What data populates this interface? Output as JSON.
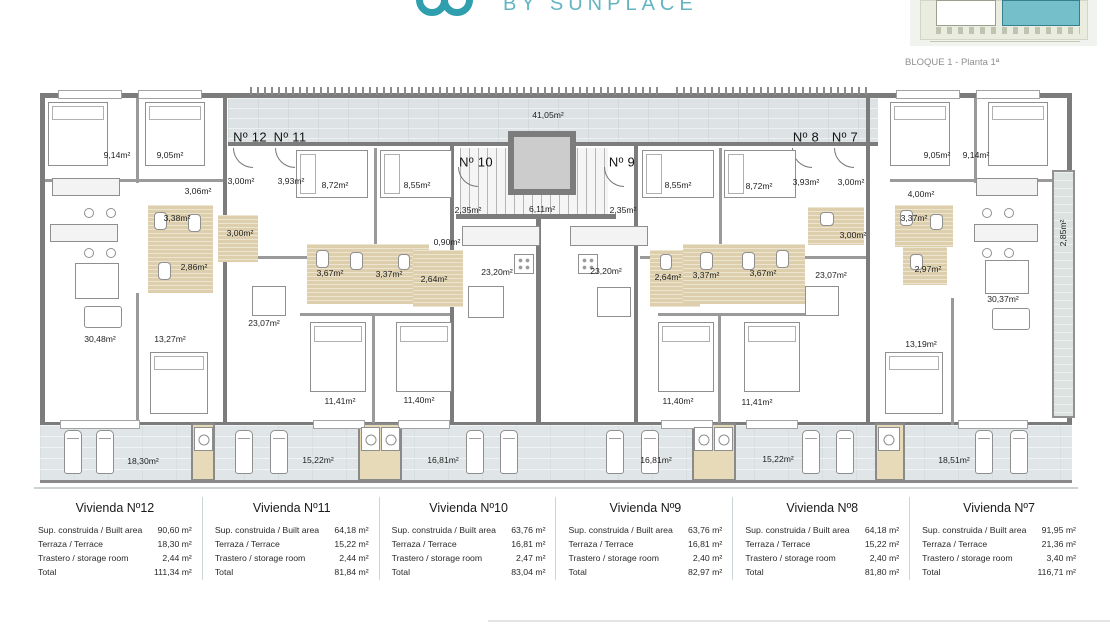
{
  "header": {
    "brand": "BY SUNPLACE"
  },
  "key_plan": {
    "caption": "BLOQUE 1 - Planta 1ª",
    "highlight_color": "#74bfc9"
  },
  "colors": {
    "teal_logo": "#2f9fae",
    "teal_text": "#63b5c1",
    "wall": "#7c7c7c",
    "terrace": "#e0e6e7",
    "bathroom": "#ddcfab"
  },
  "floorplan": {
    "labels": [
      {
        "t": "41,05m²",
        "x": 548,
        "y": 115
      },
      {
        "t": "Nº 12",
        "x": 250,
        "y": 137,
        "u": 1
      },
      {
        "t": "Nº 11",
        "x": 290,
        "y": 137,
        "u": 1
      },
      {
        "t": "Nº 10",
        "x": 476,
        "y": 162,
        "u": 1
      },
      {
        "t": "Nº 9",
        "x": 622,
        "y": 162,
        "u": 1
      },
      {
        "t": "Nº 8",
        "x": 806,
        "y": 137,
        "u": 1
      },
      {
        "t": "Nº 7",
        "x": 845,
        "y": 137,
        "u": 1
      },
      {
        "t": "9,14m²",
        "x": 117,
        "y": 155
      },
      {
        "t": "9,05m²",
        "x": 170,
        "y": 155
      },
      {
        "t": "3,06m²",
        "x": 198,
        "y": 191
      },
      {
        "t": "3,38m²",
        "x": 177,
        "y": 218
      },
      {
        "t": "3,00m²",
        "x": 241,
        "y": 181
      },
      {
        "t": "3,93m²",
        "x": 291,
        "y": 181
      },
      {
        "t": "3,00m²",
        "x": 240,
        "y": 233
      },
      {
        "t": "2,86m²",
        "x": 194,
        "y": 267
      },
      {
        "t": "8,72m²",
        "x": 335,
        "y": 185
      },
      {
        "t": "8,55m²",
        "x": 417,
        "y": 185
      },
      {
        "t": "3,67m²",
        "x": 330,
        "y": 273
      },
      {
        "t": "3,37m²",
        "x": 389,
        "y": 274
      },
      {
        "t": "2,64m²",
        "x": 434,
        "y": 279
      },
      {
        "t": "23,07m²",
        "x": 264,
        "y": 323
      },
      {
        "t": "30,48m²",
        "x": 100,
        "y": 339
      },
      {
        "t": "13,27m²",
        "x": 170,
        "y": 339
      },
      {
        "t": "11,41m²",
        "x": 340,
        "y": 401
      },
      {
        "t": "11,40m²",
        "x": 419,
        "y": 400
      },
      {
        "t": "18,30m²",
        "x": 143,
        "y": 461
      },
      {
        "t": "15,22m²",
        "x": 318,
        "y": 460
      },
      {
        "t": "16,81m²",
        "x": 443,
        "y": 460
      },
      {
        "t": "2,35m²",
        "x": 468,
        "y": 210
      },
      {
        "t": "6,11m²",
        "x": 542,
        "y": 209
      },
      {
        "t": "2,35m²",
        "x": 623,
        "y": 210
      },
      {
        "t": "0,90m²",
        "x": 447,
        "y": 242
      },
      {
        "t": "23,20m²",
        "x": 497,
        "y": 272
      },
      {
        "t": "23,20m²",
        "x": 606,
        "y": 271
      },
      {
        "t": "16,81m²",
        "x": 656,
        "y": 460
      },
      {
        "t": "8,55m²",
        "x": 678,
        "y": 185
      },
      {
        "t": "8,72m²",
        "x": 759,
        "y": 186
      },
      {
        "t": "3,93m²",
        "x": 806,
        "y": 182
      },
      {
        "t": "3,00m²",
        "x": 851,
        "y": 182
      },
      {
        "t": "3,00m²",
        "x": 853,
        "y": 235
      },
      {
        "t": "2,64m²",
        "x": 668,
        "y": 277
      },
      {
        "t": "3,37m²",
        "x": 706,
        "y": 275
      },
      {
        "t": "3,67m²",
        "x": 763,
        "y": 273
      },
      {
        "t": "23,07m²",
        "x": 831,
        "y": 275
      },
      {
        "t": "11,40m²",
        "x": 678,
        "y": 401
      },
      {
        "t": "11,41m²",
        "x": 757,
        "y": 402
      },
      {
        "t": "15,22m²",
        "x": 778,
        "y": 459
      },
      {
        "t": "9,05m²",
        "x": 937,
        "y": 155
      },
      {
        "t": "9,14m²",
        "x": 976,
        "y": 155
      },
      {
        "t": "4,00m²",
        "x": 921,
        "y": 194
      },
      {
        "t": "3,37m²",
        "x": 914,
        "y": 218
      },
      {
        "t": "2,97m²",
        "x": 928,
        "y": 269
      },
      {
        "t": "30,37m²",
        "x": 1003,
        "y": 299
      },
      {
        "t": "13,19m²",
        "x": 921,
        "y": 344
      },
      {
        "t": "18,51m²",
        "x": 954,
        "y": 460
      },
      {
        "t": "2,85m²",
        "x": 1063,
        "y": 233,
        "r": 1
      }
    ],
    "furniture": [
      [
        "bed",
        48,
        102,
        60,
        64
      ],
      [
        "bed",
        145,
        102,
        60,
        64
      ],
      [
        "bed",
        890,
        102,
        60,
        64
      ],
      [
        "bed",
        988,
        102,
        60,
        64
      ],
      [
        "bedh",
        296,
        150,
        72,
        48
      ],
      [
        "bedh",
        380,
        150,
        72,
        48
      ],
      [
        "bedh",
        642,
        150,
        72,
        48
      ],
      [
        "bedh",
        724,
        150,
        72,
        48
      ],
      [
        "bed",
        310,
        322,
        56,
        70
      ],
      [
        "bed",
        396,
        322,
        56,
        70
      ],
      [
        "bed",
        658,
        322,
        56,
        70
      ],
      [
        "bed",
        744,
        322,
        56,
        70
      ],
      [
        "bed",
        150,
        352,
        58,
        62
      ],
      [
        "bed",
        885,
        352,
        58,
        62
      ],
      [
        "table",
        75,
        263,
        44,
        36
      ],
      [
        "table",
        252,
        286,
        34,
        30
      ],
      [
        "table",
        468,
        286,
        36,
        32
      ],
      [
        "table",
        597,
        287,
        34,
        30
      ],
      [
        "table",
        805,
        286,
        34,
        30
      ],
      [
        "table",
        985,
        260,
        44,
        34
      ],
      [
        "sofa",
        84,
        306,
        38,
        22
      ],
      [
        "sofa",
        992,
        308,
        38,
        22
      ],
      [
        "counter",
        52,
        178,
        68,
        18
      ],
      [
        "counter",
        976,
        178,
        62,
        18
      ],
      [
        "counter",
        50,
        224,
        68,
        18
      ],
      [
        "counter",
        974,
        224,
        64,
        18
      ],
      [
        "counter",
        462,
        226,
        78,
        20
      ],
      [
        "counter",
        570,
        226,
        78,
        20
      ],
      [
        "stool",
        84,
        208,
        10,
        10
      ],
      [
        "stool",
        106,
        208,
        10,
        10
      ],
      [
        "stool",
        84,
        248,
        10,
        10
      ],
      [
        "stool",
        106,
        248,
        10,
        10
      ],
      [
        "stool",
        982,
        208,
        10,
        10
      ],
      [
        "stool",
        1004,
        208,
        10,
        10
      ],
      [
        "stool",
        982,
        248,
        10,
        10
      ],
      [
        "stool",
        1004,
        248,
        10,
        10
      ],
      [
        "hob",
        514,
        254,
        20,
        20
      ],
      [
        "hob",
        578,
        254,
        20,
        20
      ],
      [
        "washer",
        194,
        427,
        19,
        24
      ],
      [
        "washer",
        361,
        427,
        19,
        24
      ],
      [
        "washer",
        381,
        427,
        19,
        24
      ],
      [
        "washer",
        694,
        427,
        19,
        24
      ],
      [
        "washer",
        714,
        427,
        19,
        24
      ],
      [
        "washer",
        878,
        427,
        22,
        24
      ],
      [
        "lounger",
        64,
        430,
        18,
        44
      ],
      [
        "lounger",
        96,
        430,
        18,
        44
      ],
      [
        "lounger",
        235,
        430,
        18,
        44
      ],
      [
        "lounger",
        270,
        430,
        18,
        44
      ],
      [
        "lounger",
        466,
        430,
        18,
        44
      ],
      [
        "lounger",
        500,
        430,
        18,
        44
      ],
      [
        "lounger",
        606,
        430,
        18,
        44
      ],
      [
        "lounger",
        641,
        430,
        18,
        44
      ],
      [
        "lounger",
        802,
        430,
        18,
        44
      ],
      [
        "lounger",
        836,
        430,
        18,
        44
      ],
      [
        "lounger",
        975,
        430,
        18,
        44
      ],
      [
        "lounger",
        1010,
        430,
        18,
        44
      ],
      [
        "fix",
        154,
        212,
        13,
        18
      ],
      [
        "fix",
        188,
        214,
        13,
        18
      ],
      [
        "fix",
        158,
        262,
        13,
        18
      ],
      [
        "fix",
        316,
        250,
        13,
        18
      ],
      [
        "fix",
        350,
        252,
        13,
        18
      ],
      [
        "fix",
        398,
        254,
        12,
        16
      ],
      [
        "fix",
        660,
        254,
        12,
        16
      ],
      [
        "fix",
        700,
        252,
        13,
        18
      ],
      [
        "fix",
        742,
        252,
        13,
        18
      ],
      [
        "fix",
        776,
        250,
        13,
        18
      ],
      [
        "fix",
        820,
        212,
        14,
        14
      ],
      [
        "fix",
        900,
        210,
        13,
        16
      ],
      [
        "fix",
        930,
        214,
        13,
        16
      ],
      [
        "fix",
        910,
        254,
        13,
        16
      ]
    ]
  },
  "units_summary": [
    {
      "title": "Vivienda Nº12",
      "rows": [
        [
          "Sup. construida / Built area",
          "90,60 m²"
        ],
        [
          "Terraza / Terrace",
          "18,30 m²"
        ],
        [
          "Trastero / storage room",
          "2,44 m²"
        ],
        [
          "Total",
          "111,34 m²"
        ]
      ]
    },
    {
      "title": "Vivienda Nº11",
      "rows": [
        [
          "Sup. construida / Built area",
          "64,18 m²"
        ],
        [
          "Terraza / Terrace",
          "15,22 m²"
        ],
        [
          "Trastero / storage room",
          "2,44 m²"
        ],
        [
          "Total",
          "81,84 m²"
        ]
      ]
    },
    {
      "title": "Vivienda Nº10",
      "rows": [
        [
          "Sup. construida / Built area",
          "63,76 m²"
        ],
        [
          "Terraza / Terrace",
          "16,81 m²"
        ],
        [
          "Trastero / storage room",
          "2,47 m²"
        ],
        [
          "Total",
          "83,04 m²"
        ]
      ]
    },
    {
      "title": "Vivienda Nº9",
      "rows": [
        [
          "Sup. construida / Built area",
          "63,76 m²"
        ],
        [
          "Terraza / Terrace",
          "16,81 m²"
        ],
        [
          "Trastero / storage room",
          "2,40 m²"
        ],
        [
          "Total",
          "82,97 m²"
        ]
      ]
    },
    {
      "title": "Vivienda Nº8",
      "rows": [
        [
          "Sup. construida / Built area",
          "64,18 m²"
        ],
        [
          "Terraza / Terrace",
          "15,22 m²"
        ],
        [
          "Trastero / storage room",
          "2,40 m²"
        ],
        [
          "Total",
          "81,80 m²"
        ]
      ]
    },
    {
      "title": "Vivienda Nº7",
      "rows": [
        [
          "Sup. construida / Built area",
          "91,95 m²"
        ],
        [
          "Terraza / Terrace",
          "21,36 m²"
        ],
        [
          "Trastero / storage room",
          "3,40 m²"
        ],
        [
          "Total",
          "116,71 m²"
        ]
      ]
    }
  ]
}
